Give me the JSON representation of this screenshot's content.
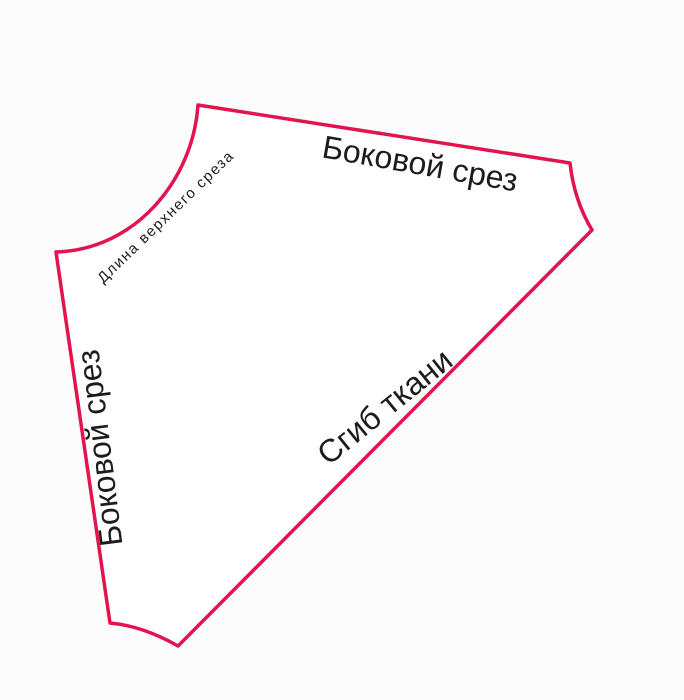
{
  "page": {
    "background_color": "#fcfcfc"
  },
  "diagram": {
    "type": "sewing-pattern-piece",
    "outline_color": "#e3134e",
    "fill_color": "#ffffff",
    "text_color": "#1c1c1c",
    "labels": {
      "top_side_cut": "Боковой срез",
      "left_side_cut": "Боковой срез",
      "upper_cut_length": "Длина верхнего среза",
      "fabric_fold": "Сгиб ткани"
    }
  }
}
